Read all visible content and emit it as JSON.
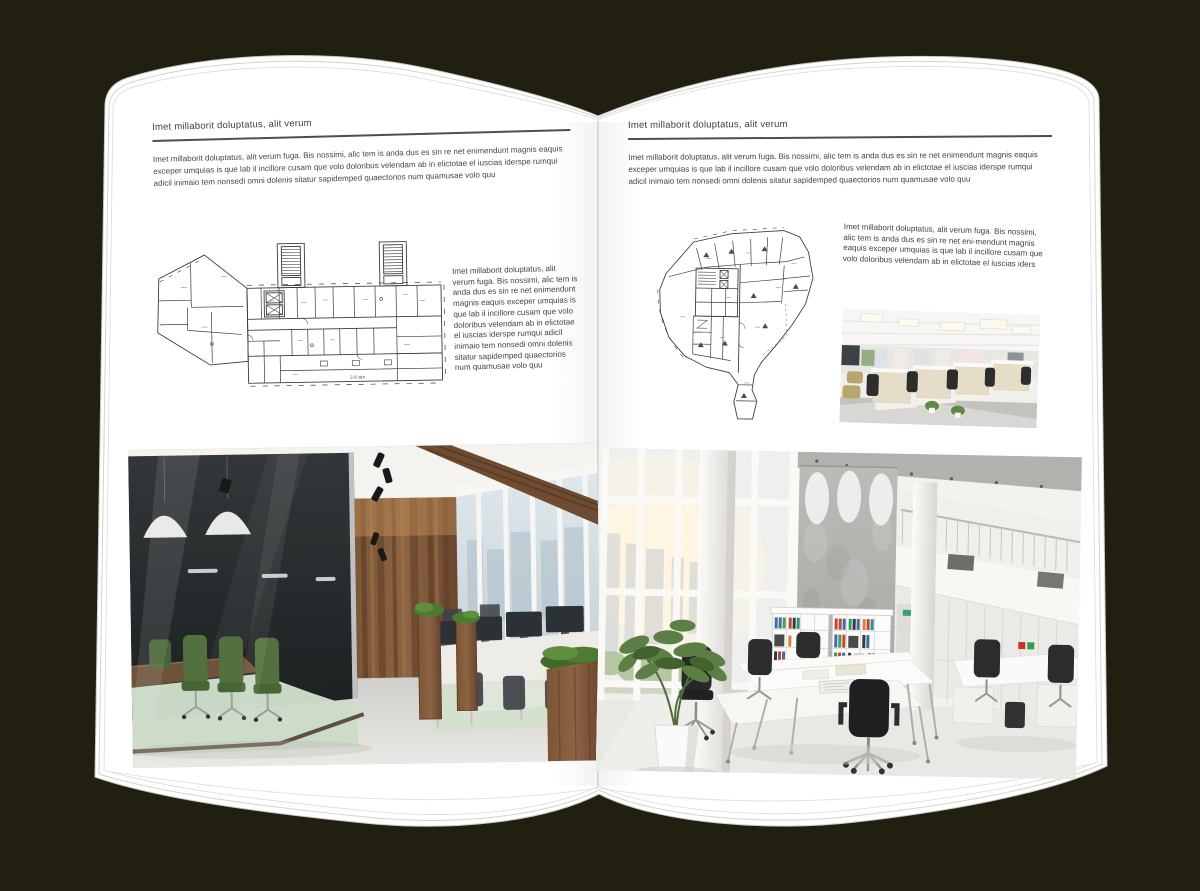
{
  "canvas": {
    "background_color": "#201f10",
    "page_color": "#ffffff"
  },
  "left_page": {
    "header": "Imet millaborit doluptatus, alit verum",
    "intro": "Imet millaborit doluptatus, alit verum fuga. Bis nossimi, alic tem is anda dus es sin re net enimendunt magnis eaquis exceper umquias is que lab il incillore cusam que volo doloribus velendam ab in elictotae el iuscias iderspe rumqui adicil inimaio tem nonsedi omni dolenis sitatur sapidemped quaectorios num quamusae volo quu",
    "side_text": "Imet millaborit doluptatus, alit verum fuga. Bis nossimi, alic tem is anda dus es sin re net enimendunt magnis eaquis exceper umquias is que lab il incillore cusam que volo doloribus velendam ab in elictotae el iuscias iderspe rumqui adicil inimaio tem nonsedi omni dolenis sitatur sapidemped quaectorios num quamusae volo quu",
    "floor_plan": {
      "name": "wide-building-floor-plan",
      "label": "2-й зал"
    },
    "photo": {
      "name": "dark-wood-open-plan-office-photo"
    }
  },
  "right_page": {
    "header": "Imet millaborit doluptatus, alit verum",
    "intro": "Imet millaborit doluptatus, alit verum fuga. Bis nossimi, alic tem is anda dus es sin re net enimendunt magnis eaquis exceper umquias is que lab il incillore cusam que volo doloribus velendam ab in elictotae el iuscias iderspe rumqui adicil inimaio tem nonsedi omni dolenis sitatur sapidemped quaectorios num quamusae volo quu",
    "side_text": "Imet millaborit doluptatus, alit verum fuga. Bis nossimi, alic tem is anda dus es sin re net eni-mendunt magnis eaquis exceper umquias is que lab il incillore cusam que volo doloribus velendam ab in elictotae el iuscias iders",
    "floor_plan": {
      "name": "fan-shaped-building-floor-plan"
    },
    "photo_small": {
      "name": "bright-cubicle-office-photo"
    },
    "photo": {
      "name": "white-atrium-office-photo"
    }
  }
}
